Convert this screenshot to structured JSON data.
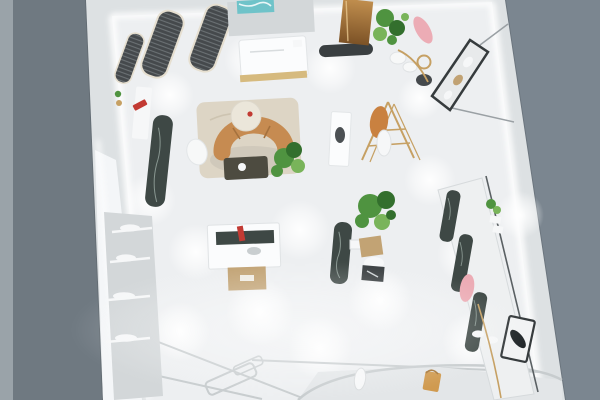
{
  "meta": {
    "description": "Bird's-eye 3D architectural render of a boutique clothing store interior with glowing white floor and display fixtures",
    "view": "top-down perspective render",
    "width_px": 600,
    "height_px": 400
  },
  "palette": {
    "backdrop_right": "#7b8690",
    "backdrop_left": "#6f7981",
    "backdrop_strip": "#9aa3a9",
    "backdrop_seam": "#5d666d",
    "wall": "#dde1e3",
    "wall_lit": "#f6f8f9",
    "floor": "#edeff1",
    "glow": "#ffffff",
    "rack_dark": "#45494c",
    "rack_frame": "#e6dfd0",
    "rug": "#ddd5c5",
    "rug_swirl": "#c9bfab",
    "sofa": "#c68b51",
    "sofa_line": "#a5713d",
    "coffee_table": "#4d4b40",
    "chair_white": "#f7f8f8",
    "ottoman": "#ebe6da",
    "plant": "#4f9340",
    "plant_dark": "#336f2d",
    "plant_light": "#79b45a",
    "planter": "#c2a374",
    "gold": "#c6a063",
    "marble": "#3e4845",
    "marble_vein": "#a8b8b0",
    "desk": "#fbfcfd",
    "desk_gold": "#d6ba7e",
    "desk_wall": "#d3d7d9",
    "art_teal": "#6fc3c9",
    "bronze_light": "#c08e4e",
    "bronze_dark": "#7c5226",
    "mat_dark": "#3a3f41",
    "cube_tan": "#c1a273",
    "pink": "#ecacb5",
    "orange_garment": "#c98140",
    "red_accent": "#c23a33",
    "bag_orange": "#d09a4f",
    "shoe_black": "#23282b",
    "frame_dark": "#363b3d",
    "floor_line": "#c7ccce",
    "platform": "#e3e6e8",
    "item_white": "#f6f7f8",
    "shelf_panel": "#d3d7d9"
  },
  "scene": {
    "objects": [
      {
        "name": "ceiling-garment-racks",
        "desc": "three dark louvered hanging-clothes racks along top-left wall"
      },
      {
        "name": "reception-desk",
        "desc": "white cashier counter with gold base, teal artwork behind"
      },
      {
        "name": "bronze-mirror",
        "desc": "bronze leaning mirror panel with dark floor mat"
      },
      {
        "name": "lounge",
        "desc": "camel curved sofa, round side table, white chair, dark coffee table, plant, beige rug"
      },
      {
        "name": "center-display-table",
        "desc": "white table with dark marble top, red item, tan display cube"
      },
      {
        "name": "gold-clothing-rack",
        "desc": "brass A-frame rack with orange and white garments"
      },
      {
        "name": "marble-slabs",
        "desc": "dark green marble display slabs with white veining"
      },
      {
        "name": "right-wall-display",
        "desc": "long wall display with marble panels, pink garment, shelves, shoe frame"
      },
      {
        "name": "angled-display-case",
        "desc": "dark framed suspended display case upper right"
      },
      {
        "name": "left-wall-shelves",
        "desc": "glass shelving with folded white garments"
      },
      {
        "name": "floor-platform",
        "desc": "curved low platform with white shoe and tan handbag"
      },
      {
        "name": "light-pools",
        "desc": "bright spotlight pools on white floor"
      }
    ]
  }
}
